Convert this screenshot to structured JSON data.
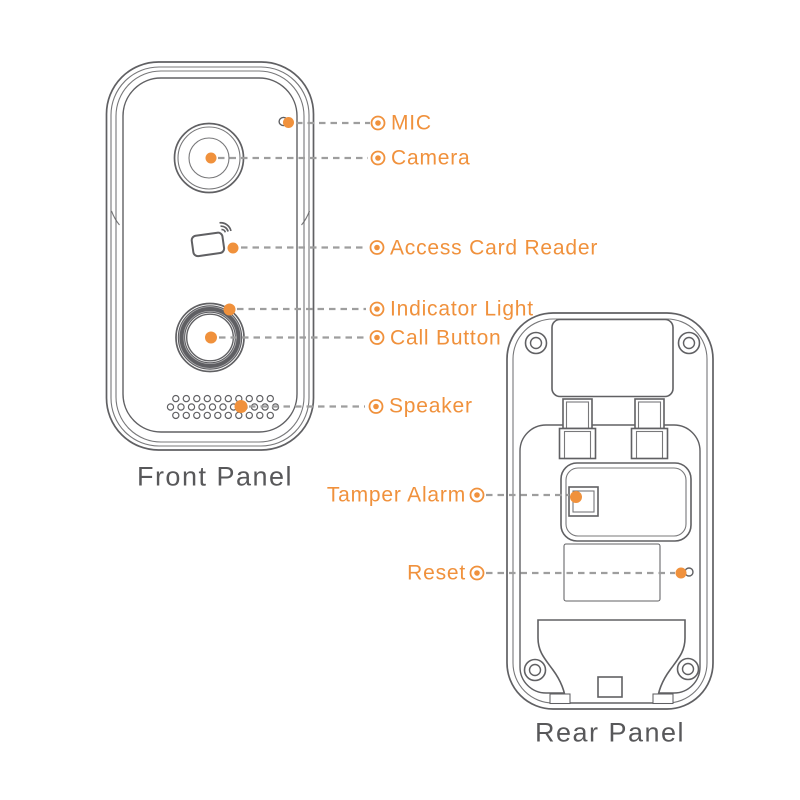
{
  "diagram": {
    "front": {
      "caption": "Front Panel",
      "labels": {
        "mic": "MIC",
        "camera": "Camera",
        "access_card_reader": "Access Card Reader",
        "indicator_light": "Indicator Light",
        "call_button": "Call Button",
        "speaker": "Speaker"
      }
    },
    "rear": {
      "caption": "Rear Panel",
      "labels": {
        "tamper_alarm": "Tamper Alarm",
        "reset": "Reset"
      }
    }
  },
  "icons": {
    "marker": "bullseye-marker",
    "mic": "mic-hole-icon",
    "camera": "camera-lens-icon",
    "access_card_reader": "rfid-card-icon",
    "indicator_light": "indicator-dot-icon",
    "call_button": "button-ring-icon",
    "speaker": "speaker-grille-icon",
    "tamper_alarm": "tamper-switch-icon",
    "reset": "reset-hole-icon"
  },
  "colors": {
    "accent": "#F0913C",
    "line": "#606063",
    "dash": "#9E9E9E",
    "caption": "#58585A"
  }
}
